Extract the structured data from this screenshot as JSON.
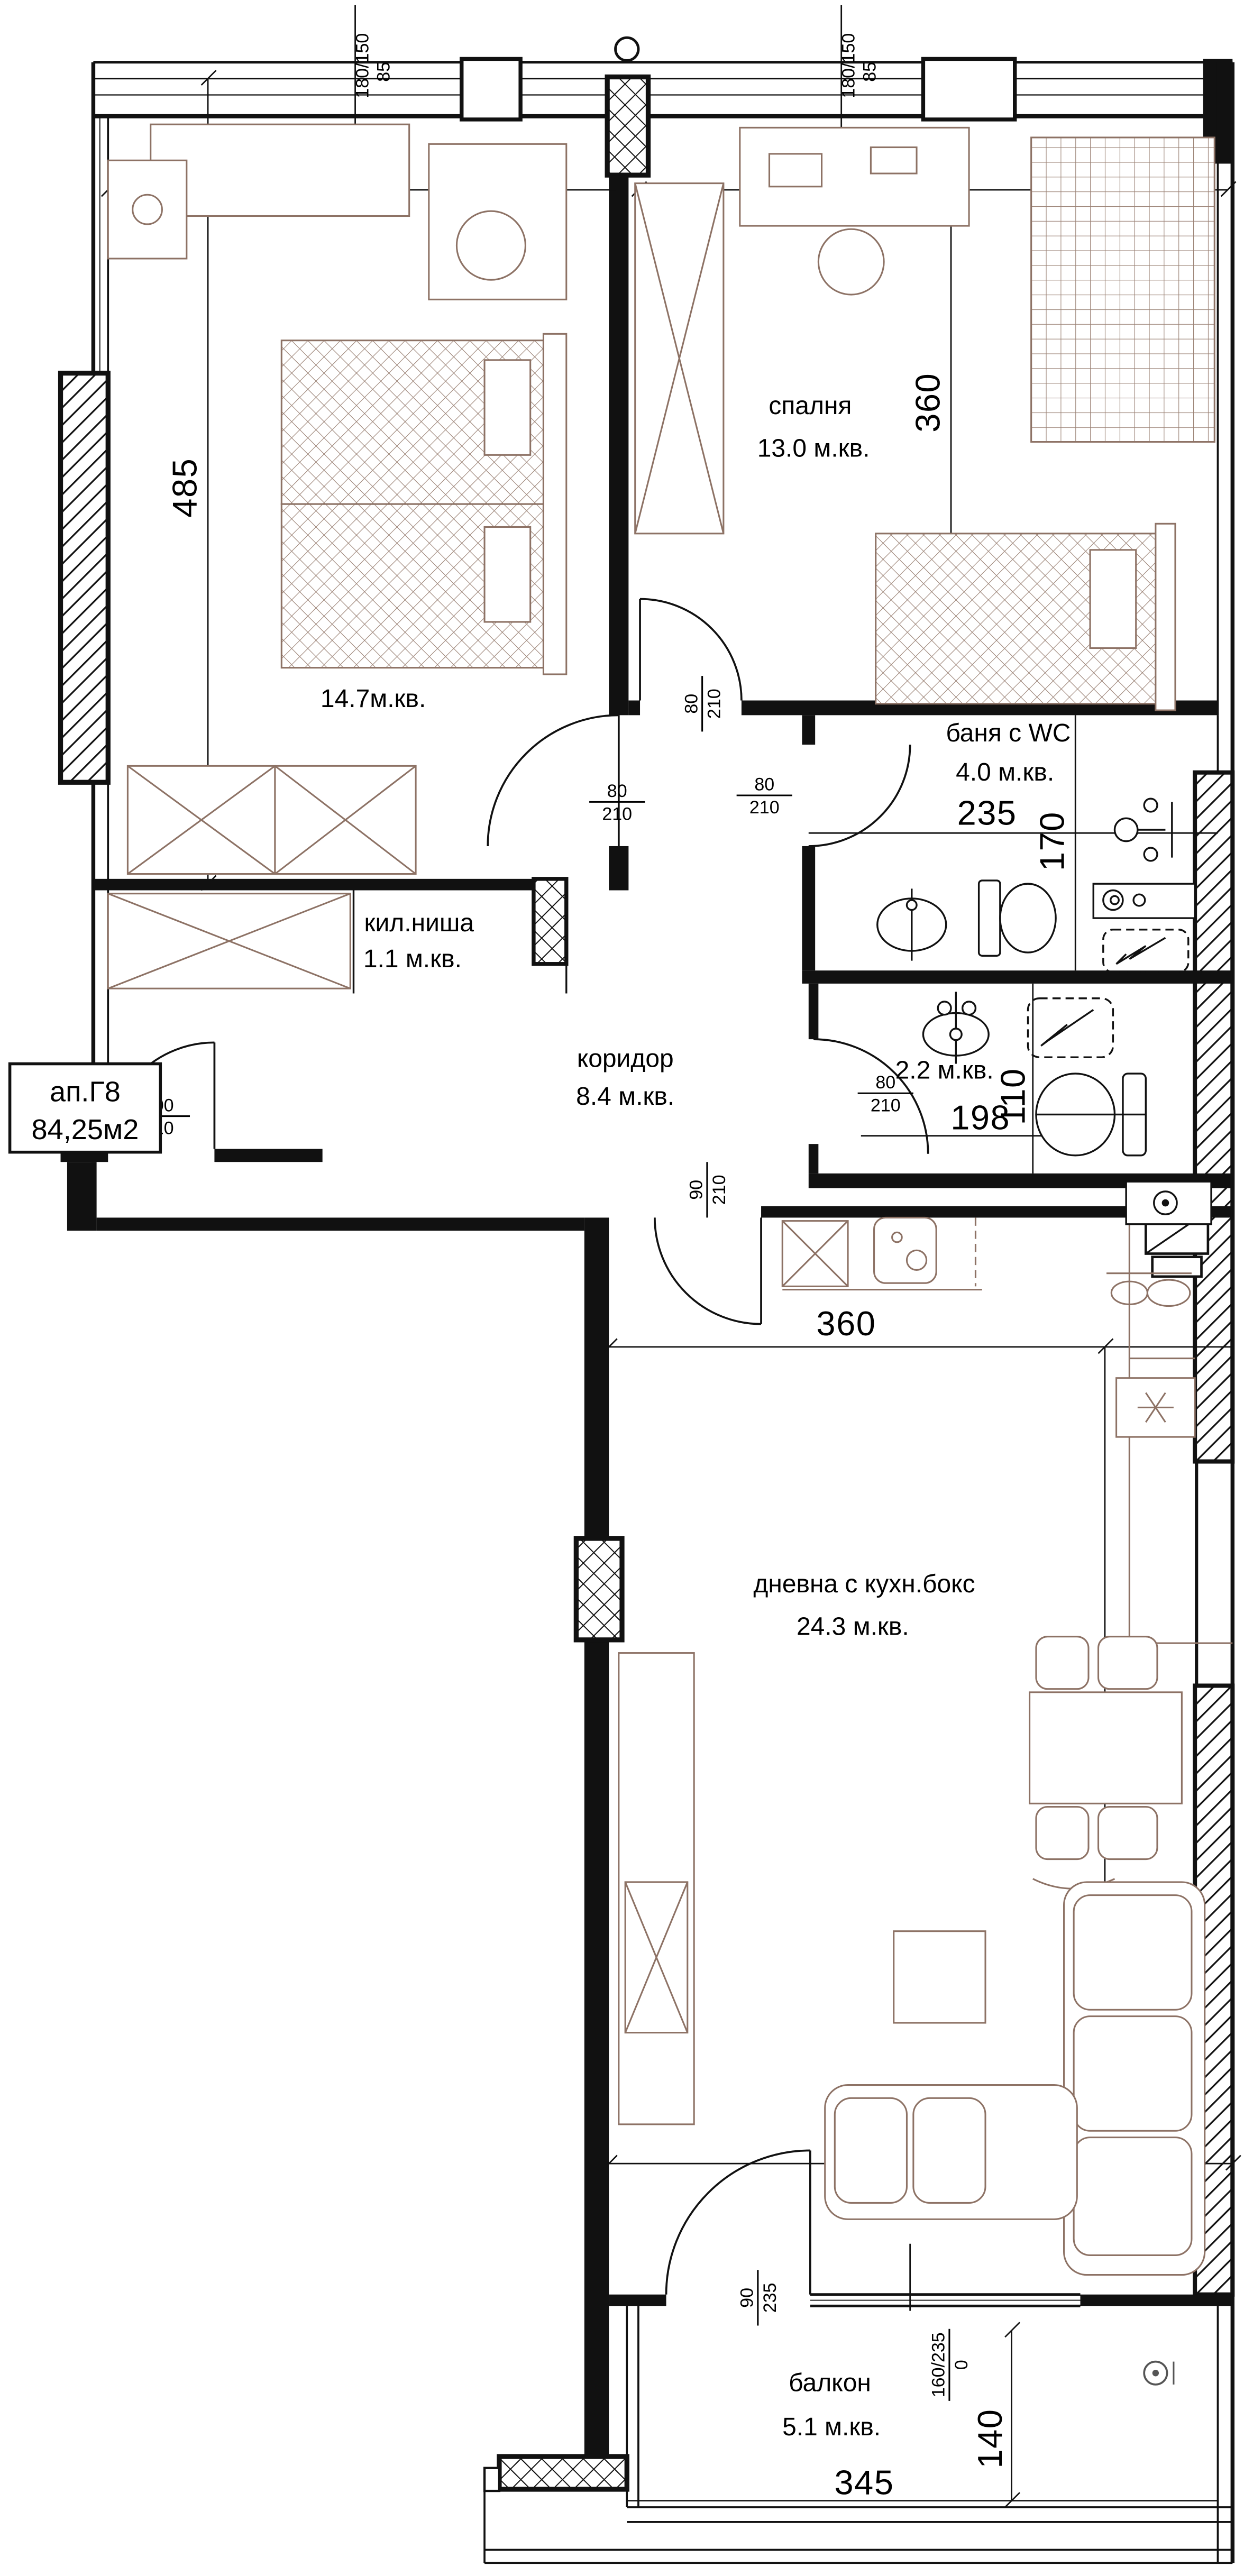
{
  "plan": {
    "apartment": {
      "id": "ап.Г8",
      "area": "84,25м2"
    },
    "rooms": [
      {
        "key": "bedroom-1",
        "name": "спалня",
        "area": "14.7м.кв."
      },
      {
        "key": "bedroom-2",
        "name": "спалня",
        "area": "13.0 м.кв."
      },
      {
        "key": "bathroom",
        "name": "баня с WC",
        "area": "4.0 м.кв."
      },
      {
        "key": "closet-niche",
        "name": "кил.ниша",
        "area": "1.1 м.кв."
      },
      {
        "key": "corridor",
        "name": "коридор",
        "area": "8.4 м.кв."
      },
      {
        "key": "wc",
        "name": "WC",
        "area": "2.2 м.кв."
      },
      {
        "key": "living-kitchen",
        "name": "дневна с кухн.бокс",
        "area": "24.3 м.кв."
      },
      {
        "key": "balcony",
        "name": "балкон",
        "area": "5.1 м.кв."
      }
    ],
    "dimensions": {
      "top_left": "303",
      "top_right": "360",
      "left_height": "485",
      "bedroom2_right": "360",
      "bath_width": "235",
      "bath_height": "170",
      "wc_width": "198",
      "wc_height": "110",
      "kitchen_width": "360",
      "living_height": "676",
      "living_width": "360",
      "balcony_width": "345",
      "balcony_depth": "140"
    },
    "openings": {
      "window_top_left": {
        "size": "180/150",
        "sill": "85"
      },
      "window_top_right": {
        "size": "180/150",
        "sill": "85"
      },
      "door_bedroom1": {
        "w": "80",
        "h": "210"
      },
      "door_bedroom2": {
        "w": "80",
        "h": "210"
      },
      "door_bath": {
        "w": "80",
        "h": "210"
      },
      "door_wc": {
        "w": "80",
        "h": "210"
      },
      "door_entry": {
        "w": "100",
        "h": "210"
      },
      "door_living": {
        "w": "90",
        "h": "210"
      },
      "door_balcony": {
        "w": "90",
        "h": "235"
      },
      "window_balcony": {
        "size": "160/235",
        "sill": "0"
      }
    },
    "colors": {
      "wall": "#111111",
      "furniture": "#8d7265"
    }
  }
}
